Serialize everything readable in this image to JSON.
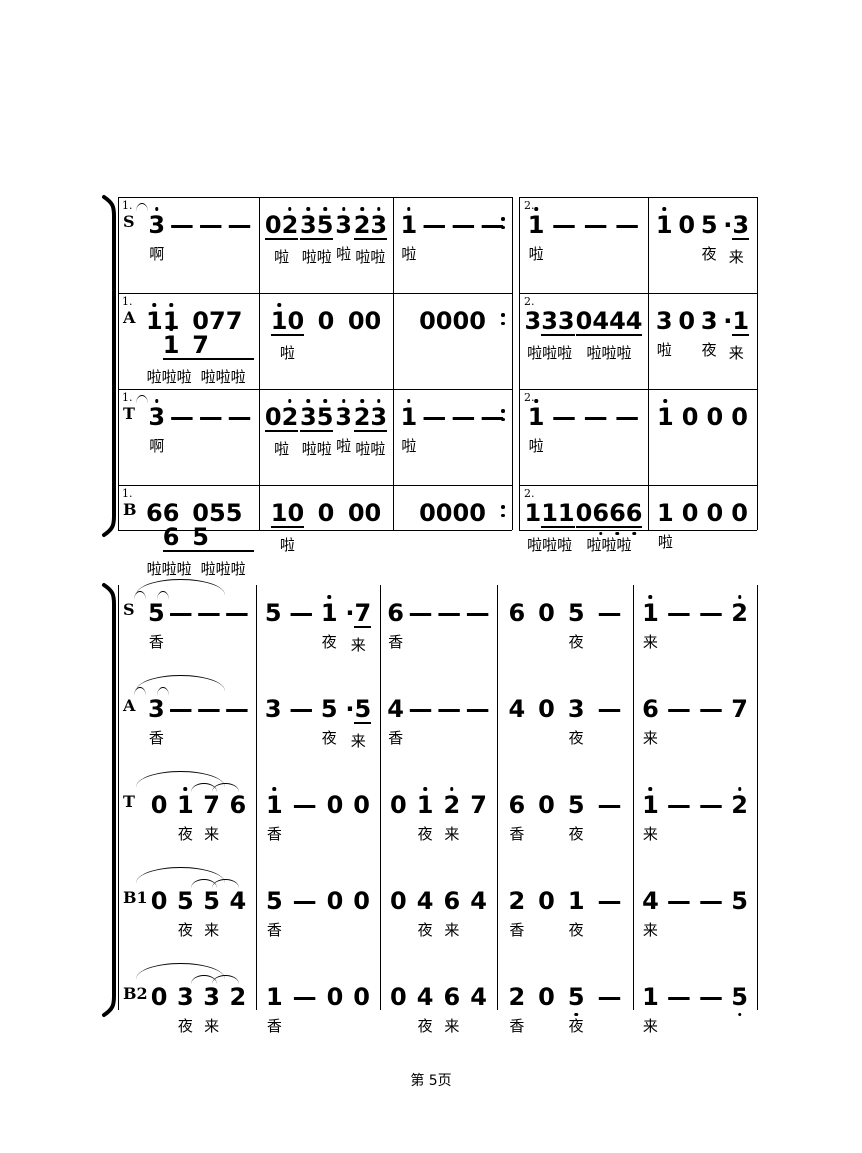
{
  "page": {
    "footer_label": "第 5页",
    "background": "#ffffff",
    "ink_color": "#000000"
  },
  "score": {
    "system1": {
      "ending_labels": [
        "1.",
        "2."
      ],
      "parts": [
        {
          "label": "S",
          "repeat_dots": true,
          "measures": [
            {
              "tokens": [
                "3'",
                "—",
                "—",
                "—"
              ],
              "lyrics": [
                "啊",
                "",
                "",
                ""
              ]
            },
            {
              "tokens": [
                "_02'_",
                "_3'5'_",
                "3'",
                "_2'3'_"
              ],
              "lyrics": [
                "啦",
                "啦啦",
                "啦",
                "啦啦"
              ]
            },
            {
              "tokens": [
                "1'",
                "—",
                "—",
                "—"
              ],
              "lyrics": [
                "啦",
                "",
                "",
                ""
              ]
            },
            {
              "tokens": [
                "1'",
                "—",
                "—",
                "—"
              ],
              "lyrics": [
                "啦",
                "",
                "",
                ""
              ]
            },
            {
              "tokens": [
                "1'",
                "0",
                "5",
                "·_3_"
              ],
              "lyrics": [
                "",
                "",
                "夜",
                "来"
              ]
            }
          ],
          "slurs": [
            {
              "from": [
                3,
                0
              ],
              "to": [
                4,
                0
              ]
            }
          ]
        },
        {
          "label": "A",
          "repeat_dots": true,
          "measures": [
            {
              "tokens": [
                "1'_1'1'_",
                "_0777_"
              ],
              "lyrics": [
                "啦啦啦",
                "啦啦啦"
              ]
            },
            {
              "tokens": [
                "_1'0_",
                "0",
                "00"
              ],
              "lyrics": [
                "啦",
                "",
                ""
              ]
            },
            {
              "tokens": [
                "0000"
              ],
              "lyrics": [
                ""
              ]
            },
            {
              "tokens": [
                "3_33_",
                "_0444_"
              ],
              "lyrics": [
                "啦啦啦",
                "啦啦啦"
              ]
            },
            {
              "tokens": [
                "3",
                "0",
                "3",
                "·_1_"
              ],
              "lyrics": [
                "啦",
                "",
                "夜",
                "来"
              ]
            }
          ],
          "slurs": []
        },
        {
          "label": "T",
          "repeat_dots": true,
          "measures": [
            {
              "tokens": [
                "3'",
                "—",
                "—",
                "—"
              ],
              "lyrics": [
                "啊",
                "",
                "",
                ""
              ]
            },
            {
              "tokens": [
                "_02'_",
                "_3'5'_",
                "3'",
                "_2'3'_"
              ],
              "lyrics": [
                "啦",
                "啦啦",
                "啦",
                "啦啦"
              ]
            },
            {
              "tokens": [
                "1'",
                "—",
                "—",
                "—"
              ],
              "lyrics": [
                "啦",
                "",
                "",
                ""
              ]
            },
            {
              "tokens": [
                "1'",
                "—",
                "—",
                "—"
              ],
              "lyrics": [
                "啦",
                "",
                "",
                ""
              ]
            },
            {
              "tokens": [
                "1'",
                "0",
                "0",
                "0"
              ],
              "lyrics": [
                "",
                "",
                "",
                ""
              ]
            }
          ],
          "slurs": [
            {
              "from": [
                3,
                0
              ],
              "to": [
                4,
                0
              ]
            }
          ]
        },
        {
          "label": "B",
          "repeat_dots": true,
          "measures": [
            {
              "tokens": [
                "6_66_",
                "_0555_"
              ],
              "lyrics": [
                "啦啦啦",
                "啦啦啦"
              ]
            },
            {
              "tokens": [
                "_10_",
                "0",
                "00"
              ],
              "lyrics": [
                "啦",
                "",
                ""
              ]
            },
            {
              "tokens": [
                "0000"
              ],
              "lyrics": [
                ""
              ]
            },
            {
              "tokens": [
                "1_11_",
                "_06,6,6,_"
              ],
              "lyrics": [
                "啦啦啦",
                "啦啦啦"
              ]
            },
            {
              "tokens": [
                "1",
                "0",
                "0",
                "0"
              ],
              "lyrics": [
                "啦",
                "",
                "",
                ""
              ]
            }
          ],
          "slurs": []
        }
      ]
    },
    "system2": {
      "parts": [
        {
          "label": "S",
          "measures": [
            {
              "tokens": [
                "5",
                "—",
                "—",
                "—"
              ],
              "lyrics": [
                "香",
                "",
                "",
                ""
              ]
            },
            {
              "tokens": [
                "5",
                "—",
                "1'",
                "·_7_"
              ],
              "lyrics": [
                "",
                "",
                "夜",
                "来"
              ]
            },
            {
              "tokens": [
                "6",
                "—",
                "—",
                "—"
              ],
              "lyrics": [
                "香",
                "",
                "",
                ""
              ]
            },
            {
              "tokens": [
                "6",
                "0",
                "5",
                "—"
              ],
              "lyrics": [
                "",
                "",
                "夜",
                ""
              ]
            },
            {
              "tokens": [
                "1'",
                "—",
                "—",
                "2'"
              ],
              "lyrics": [
                "来",
                "",
                "",
                ""
              ]
            }
          ],
          "slurs": [
            {
              "from": [
                0,
                0
              ],
              "to": [
                1,
                0
              ]
            },
            {
              "from": [
                2,
                0
              ],
              "to": [
                3,
                0
              ]
            },
            {
              "from": [
                4,
                0
              ],
              "to": [
                4,
                3
              ]
            }
          ]
        },
        {
          "label": "A",
          "measures": [
            {
              "tokens": [
                "3",
                "—",
                "—",
                "—"
              ],
              "lyrics": [
                "香",
                "",
                "",
                ""
              ]
            },
            {
              "tokens": [
                "3",
                "—",
                "5",
                "·_5_"
              ],
              "lyrics": [
                "",
                "",
                "夜",
                "来"
              ]
            },
            {
              "tokens": [
                "4",
                "—",
                "—",
                "—"
              ],
              "lyrics": [
                "香",
                "",
                "",
                ""
              ]
            },
            {
              "tokens": [
                "4",
                "0",
                "3",
                "—"
              ],
              "lyrics": [
                "",
                "",
                "夜",
                ""
              ]
            },
            {
              "tokens": [
                "6",
                "—",
                "—",
                "7"
              ],
              "lyrics": [
                "来",
                "",
                "",
                ""
              ]
            }
          ],
          "slurs": [
            {
              "from": [
                0,
                0
              ],
              "to": [
                1,
                0
              ]
            },
            {
              "from": [
                2,
                0
              ],
              "to": [
                3,
                0
              ]
            },
            {
              "from": [
                4,
                0
              ],
              "to": [
                4,
                3
              ]
            }
          ]
        },
        {
          "label": "T",
          "measures": [
            {
              "tokens": [
                "0",
                "1'",
                "7",
                "6"
              ],
              "lyrics": [
                "",
                "夜",
                "来",
                ""
              ]
            },
            {
              "tokens": [
                "1'",
                "—",
                "0",
                "0"
              ],
              "lyrics": [
                "香",
                "",
                "",
                ""
              ]
            },
            {
              "tokens": [
                "0",
                "1'",
                "2'",
                "7"
              ],
              "lyrics": [
                "",
                "夜",
                "来",
                ""
              ]
            },
            {
              "tokens": [
                "6",
                "0",
                "5",
                "—"
              ],
              "lyrics": [
                "香",
                "",
                "夜",
                ""
              ]
            },
            {
              "tokens": [
                "1'",
                "—",
                "—",
                "2'"
              ],
              "lyrics": [
                "来",
                "",
                "",
                ""
              ]
            }
          ],
          "slurs": [
            {
              "from": [
                0,
                2
              ],
              "to": [
                0,
                3
              ]
            },
            {
              "from": [
                2,
                2
              ],
              "to": [
                2,
                3
              ]
            },
            {
              "from": [
                4,
                0
              ],
              "to": [
                4,
                3
              ]
            }
          ]
        },
        {
          "label": "B1",
          "measures": [
            {
              "tokens": [
                "0",
                "5",
                "5",
                "4"
              ],
              "lyrics": [
                "",
                "夜",
                "来",
                ""
              ]
            },
            {
              "tokens": [
                "5",
                "—",
                "0",
                "0"
              ],
              "lyrics": [
                "香",
                "",
                "",
                ""
              ]
            },
            {
              "tokens": [
                "0",
                "4",
                "6",
                "4"
              ],
              "lyrics": [
                "",
                "夜",
                "来",
                ""
              ]
            },
            {
              "tokens": [
                "2",
                "0",
                "1",
                "—"
              ],
              "lyrics": [
                "香",
                "",
                "夜",
                ""
              ]
            },
            {
              "tokens": [
                "4",
                "—",
                "—",
                "5"
              ],
              "lyrics": [
                "来",
                "",
                "",
                ""
              ]
            }
          ],
          "slurs": [
            {
              "from": [
                0,
                2
              ],
              "to": [
                0,
                3
              ]
            },
            {
              "from": [
                2,
                2
              ],
              "to": [
                2,
                3
              ]
            },
            {
              "from": [
                4,
                0
              ],
              "to": [
                4,
                3
              ]
            }
          ]
        },
        {
          "label": "B2",
          "measures": [
            {
              "tokens": [
                "0",
                "3",
                "3",
                "2"
              ],
              "lyrics": [
                "",
                "夜",
                "来",
                ""
              ]
            },
            {
              "tokens": [
                "1",
                "—",
                "0",
                "0"
              ],
              "lyrics": [
                "香",
                "",
                "",
                ""
              ]
            },
            {
              "tokens": [
                "0",
                "4",
                "6",
                "4"
              ],
              "lyrics": [
                "",
                "夜",
                "来",
                ""
              ]
            },
            {
              "tokens": [
                "2",
                "0",
                "5,",
                "—"
              ],
              "lyrics": [
                "香",
                "",
                "夜",
                ""
              ]
            },
            {
              "tokens": [
                "1",
                "—",
                "—",
                "5,"
              ],
              "lyrics": [
                "来",
                "",
                "",
                ""
              ]
            }
          ],
          "slurs": [
            {
              "from": [
                0,
                2
              ],
              "to": [
                0,
                3
              ]
            },
            {
              "from": [
                2,
                2
              ],
              "to": [
                2,
                3
              ]
            },
            {
              "from": [
                4,
                0
              ],
              "to": [
                4,
                3
              ]
            }
          ]
        }
      ]
    }
  }
}
